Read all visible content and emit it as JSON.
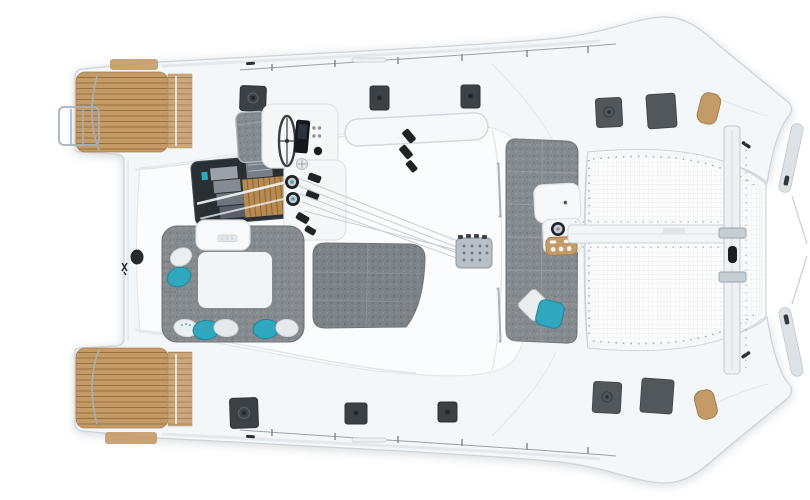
{
  "meta": {
    "description": "Top-down deck plan render of a sailing catamaran, bow to the right, sterns with teak swim platforms to the left",
    "visible_text": ""
  },
  "colors": {
    "hull": "#f4f7f9",
    "roof": "#fafcfd",
    "edge": "#ccd3da",
    "teal": "#2fa8be",
    "teal_dark": "#1f8598",
    "teak": "#c49a66",
    "teak_dark": "#96713f",
    "cushion": "#868b8f",
    "cushion_seam": "#6f7478",
    "sunpad": "#7e8387",
    "hatch": "#3c4145",
    "hatch_light": "#52575c",
    "chrome": "#a7b0b8",
    "net_line": "#dfe4e9",
    "dark": "#26292c",
    "pillow_light": "#e9edf0",
    "background": "#ffffff"
  },
  "parts": {
    "stern": [
      "port-swim-platform",
      "starboard-swim-platform",
      "swim-ladder",
      "transom-steps"
    ],
    "cockpit": [
      "u-shaped-sofa",
      "cockpit-table",
      "throw-pillows",
      "sunpad"
    ],
    "helm": [
      "steering-wheel",
      "instrument-panel",
      "winches",
      "rope-clutches",
      "halyard-lines",
      "helm-bench"
    ],
    "coachroof": [
      "salon-skylight",
      "roof-window",
      "mast-base-plate"
    ],
    "foredeck": [
      "forward-lounge-bench",
      "forward-console",
      "drink-tray",
      "forward-winch",
      "pillows",
      "grab-rails"
    ],
    "bow": [
      "trampoline-net",
      "central-beam",
      "forward-crossbeam",
      "anchor-roller",
      "bow-teak-pads",
      "bow-lockers"
    ],
    "deck": [
      "deck-hatches",
      "lifelines",
      "cleats"
    ]
  }
}
